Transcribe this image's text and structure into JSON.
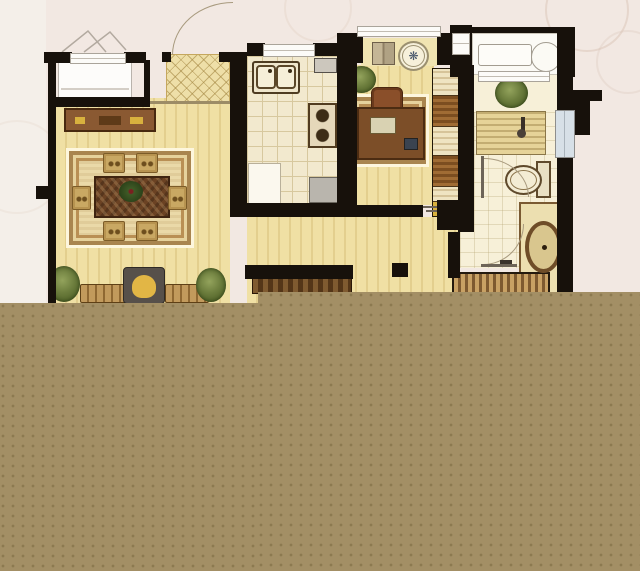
{
  "canvas": {
    "width": 640,
    "height": 571
  },
  "palette": {
    "background": "#f2e8e2",
    "background_left": "#f4efe9",
    "wall": "#17110b",
    "stripe_light": "#f0e0a4",
    "stripe_dark": "#e3cf8e",
    "kitchen_floor": "#f2e9ce",
    "grid_line": "#d7c89e",
    "bath_floor": "#f7f0d8",
    "balcony_floor": "#fbfaf5",
    "mat": "#eedfa8",
    "rug": "#ead9a8",
    "rug_border": "#a9854f",
    "wood_dark": "#6b4223",
    "wood_mid": "#8a5932",
    "wood_light": "#c9a863",
    "cushion": "#e2b645",
    "plant_dark": "#45571f",
    "plant_light": "#93a35c",
    "window_white": "#fcfbf8",
    "window_frame": "#aaa49a",
    "window_blue": "#d7e0e7",
    "arc": "#a89a7e",
    "overlay": "#a38f65",
    "overlay_dot": "#8c7950",
    "shower_light": "#e6d398",
    "shower_dark": "#c3ad72",
    "cabinet_light": "#c8a164",
    "cabinet_dark": "#7e5a30",
    "gold": "#d8b13e",
    "appliance_gray": "#b9b5ad"
  },
  "floorplan": {
    "type": "residential-floor-plan",
    "rooms": [
      {
        "name": "dining-living-room",
        "floor": "striped-wood"
      },
      {
        "name": "entry-foyer",
        "floor": "diamond-mat"
      },
      {
        "name": "kitchen",
        "floor": "tile-grid"
      },
      {
        "name": "study",
        "floor": "striped-wood"
      },
      {
        "name": "bathroom",
        "floor": "pale-tile"
      },
      {
        "name": "balcony",
        "floor": "white"
      }
    ],
    "furniture": [
      "bay-window",
      "entry-door-arc",
      "sideboard-console",
      "dining-rug",
      "dining-table",
      "dining-chairs-x6",
      "flower-centerpiece",
      "sofa-benches",
      "armchair-with-cushion",
      "potted-plants-x4",
      "double-sink",
      "stove-2-burner",
      "kitchen-island",
      "refrigerator",
      "desk",
      "desk-chair",
      "laptop",
      "wardrobe-shelves",
      "ceiling-fan-medallion",
      "folding-shutter",
      "shower-stall",
      "shower-head",
      "toilet",
      "vanity-oval-sink",
      "bath-door-arcs-x2",
      "striped-cabinet",
      "tv-console",
      "laundry-counter",
      "round-washer"
    ],
    "icon_glyphs": {
      "fan_medallion": "❋"
    }
  },
  "overlay_block": {
    "step_x": 258,
    "left_top_y": 303,
    "right_top_y": 292
  }
}
